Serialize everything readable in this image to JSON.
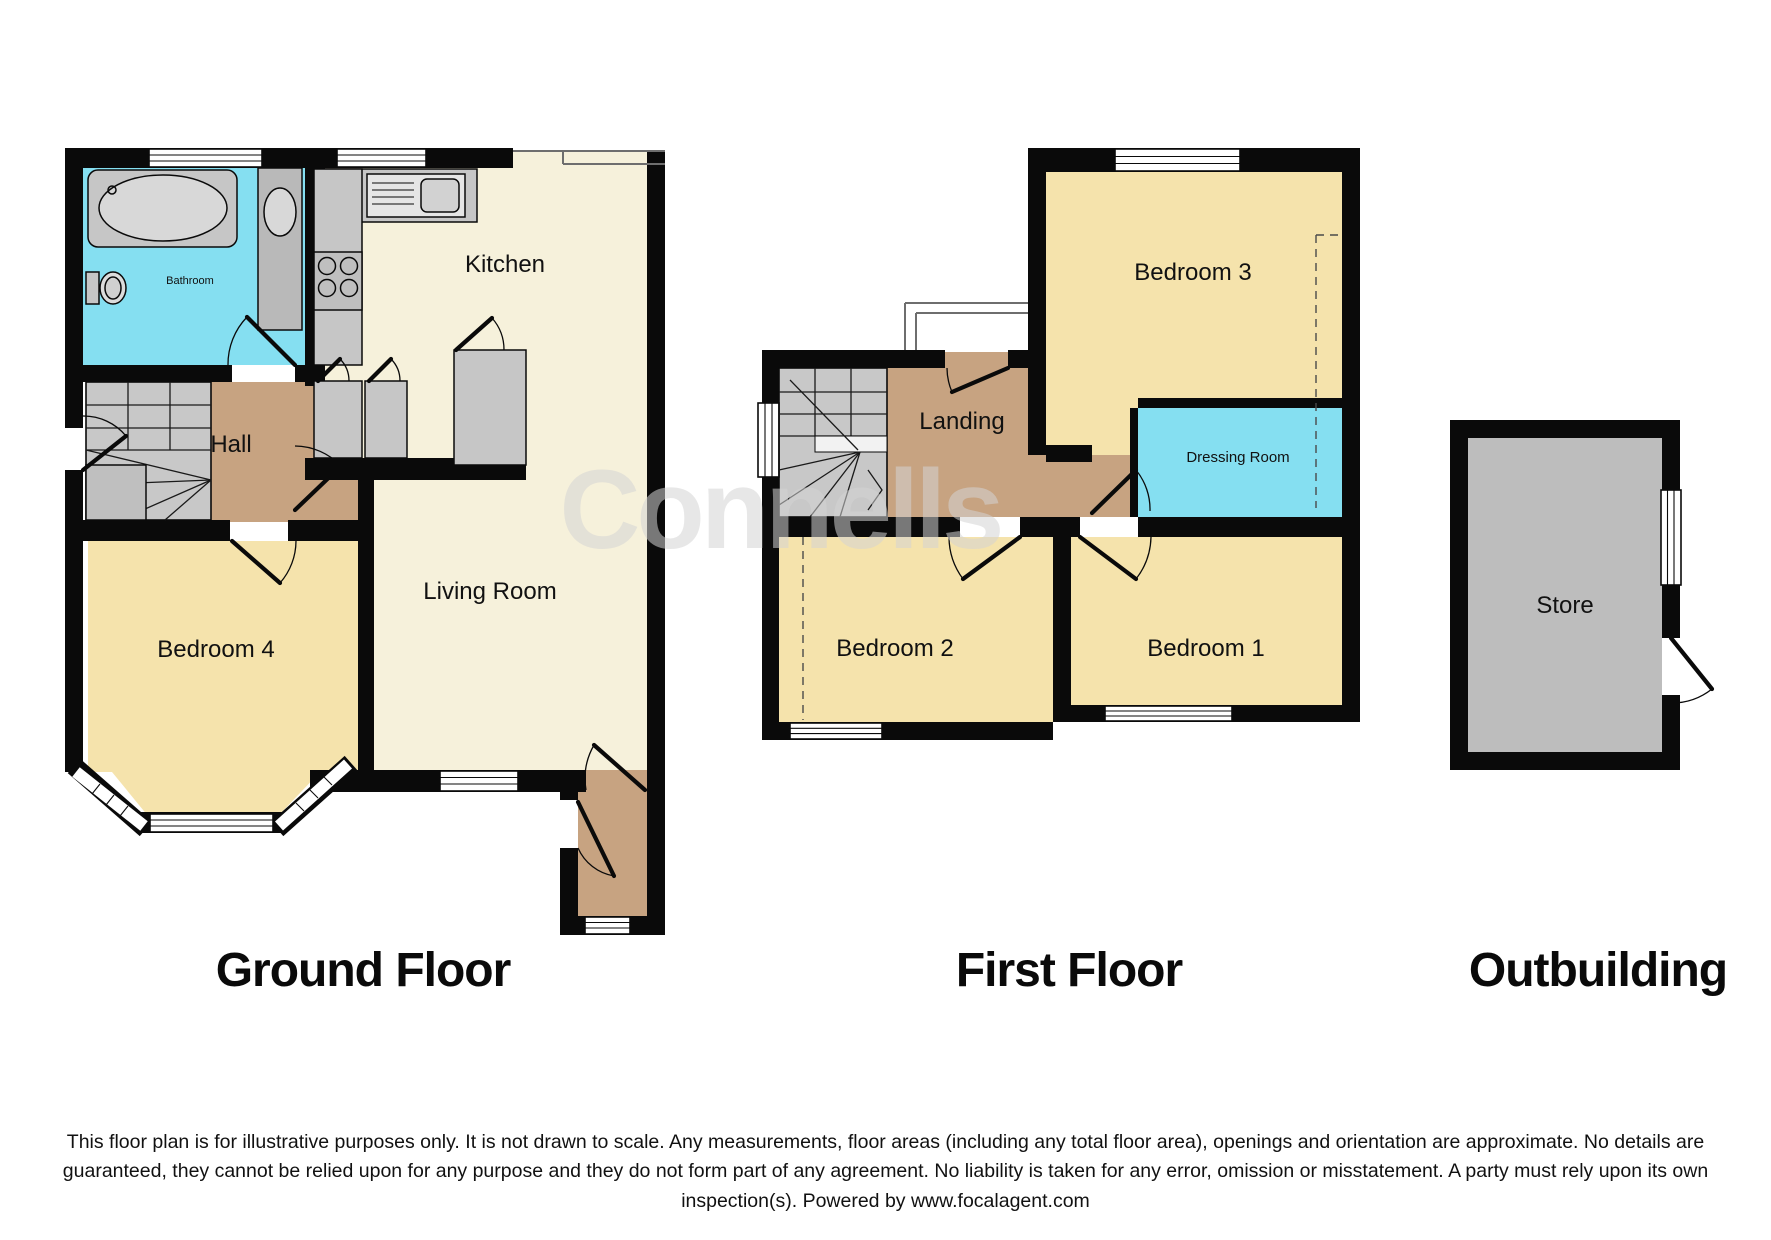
{
  "watermark_text": "Connells",
  "colors": {
    "room_cream": "#F6F1DB",
    "room_yellow": "#F5E3AC",
    "room_tan": "#C7A381",
    "room_cyan": "#85DFF1",
    "room_gray": "#BDBDBD",
    "stairs_gray": "#C8C8C8",
    "fixture_gray": "#C6C6C6",
    "tread_white": "#F2F2F2",
    "wall_black": "#0A0A0A"
  },
  "ground_floor": {
    "label": "Ground Floor",
    "rooms": {
      "bathroom": "Bathroom",
      "kitchen": "Kitchen",
      "hall": "Hall",
      "bedroom4": "Bedroom 4",
      "living_room": "Living Room"
    }
  },
  "first_floor": {
    "label": "First Floor",
    "rooms": {
      "landing": "Landing",
      "bedroom3": "Bedroom 3",
      "dressing_room": "Dressing Room",
      "bedroom2": "Bedroom 2",
      "bedroom1": "Bedroom 1"
    }
  },
  "outbuilding": {
    "label": "Outbuilding",
    "rooms": {
      "store": "Store"
    }
  },
  "disclaimer": "This floor plan is for illustrative purposes only. It is not drawn to scale. Any measurements, floor areas (including any total floor area), openings and orientation are approximate. No details are guaranteed, they cannot be relied upon for any purpose and they do not form part of any agreement. No liability is taken for any error, omission or misstatement. A party must rely upon its own inspection(s). Powered by www.focalagent.com"
}
